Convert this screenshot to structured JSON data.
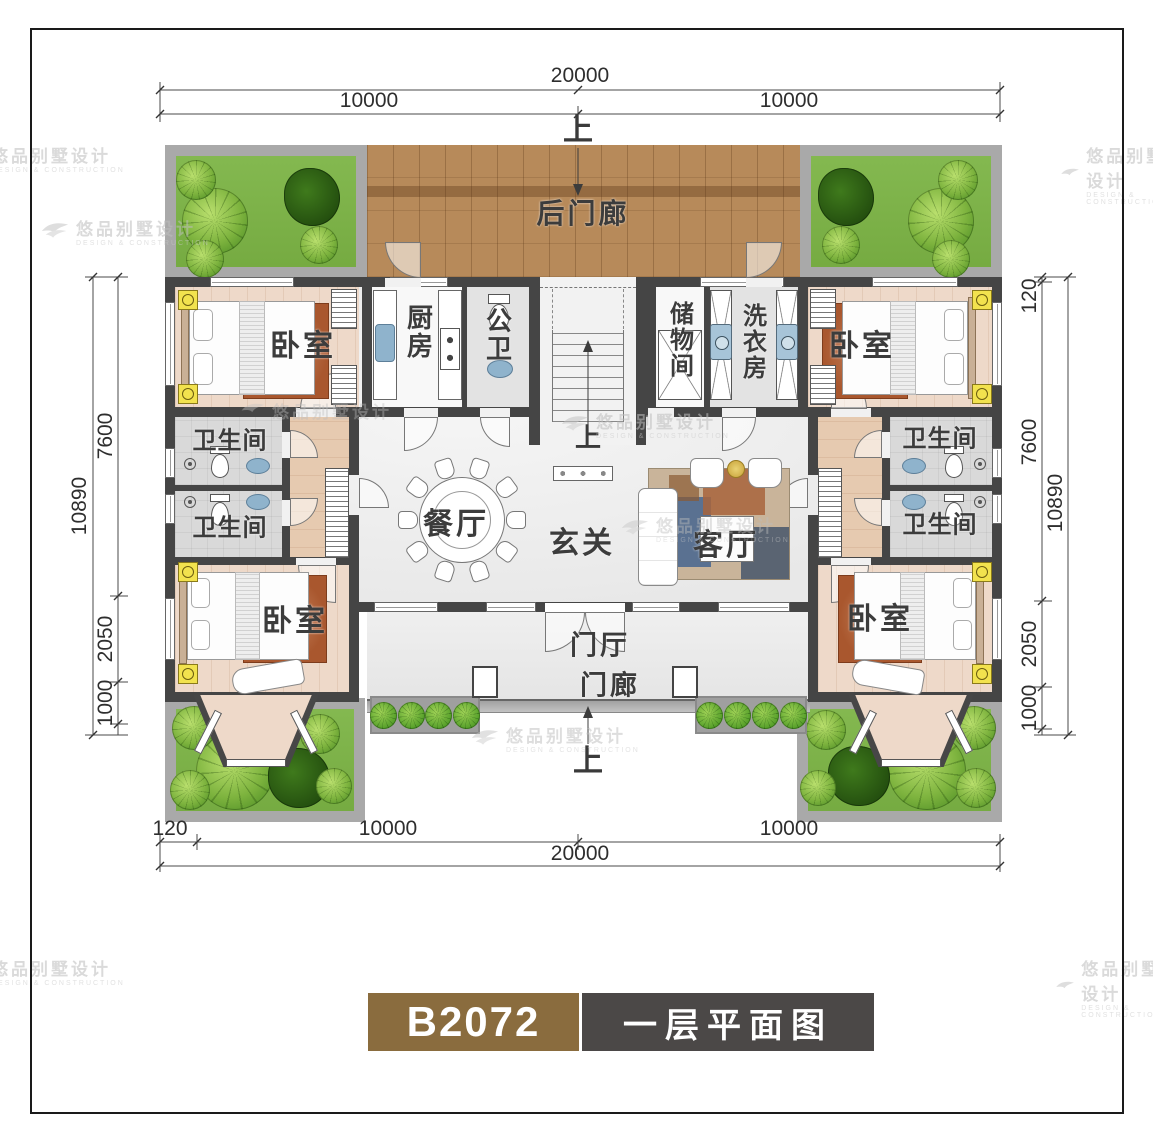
{
  "page": {
    "background": "#ffffff",
    "border_color": "#1a1a1a"
  },
  "title_block": {
    "model": "B2072",
    "drawing_name": "一层平面图",
    "model_bg": "#8a6c3e",
    "drawing_bg": "#4b4847"
  },
  "watermark": {
    "brand": "悠品别墅设计",
    "tagline": "DESIGN & CONSTRUCTION"
  },
  "labels": {
    "back_porch": "后门廊",
    "bedroom": "卧室",
    "kitchen": "厨房",
    "public_wc": "公卫",
    "storage": "储物间",
    "laundry": "洗衣房",
    "bathroom": "卫生间",
    "dining": "餐厅",
    "foyer": "玄关",
    "living": "客厅",
    "entry_hall": "门厅",
    "front_porch": "门廊",
    "up": "上"
  },
  "dimensions": {
    "total_width": "20000",
    "half_width": "10000",
    "total_depth": "10890",
    "depth_upper": "7600",
    "depth_mid": "2050",
    "depth_lower": "1000",
    "side_offset": "120"
  },
  "palette": {
    "wall": "#454545",
    "wood_deck": "#b78a5a",
    "grass": "#7cb445",
    "bedroom_floor": "#eed9c9",
    "rug_rust": "#a9572e",
    "fixture_blue": "#8fb3cc",
    "dim_text": "#2e2e2e"
  }
}
